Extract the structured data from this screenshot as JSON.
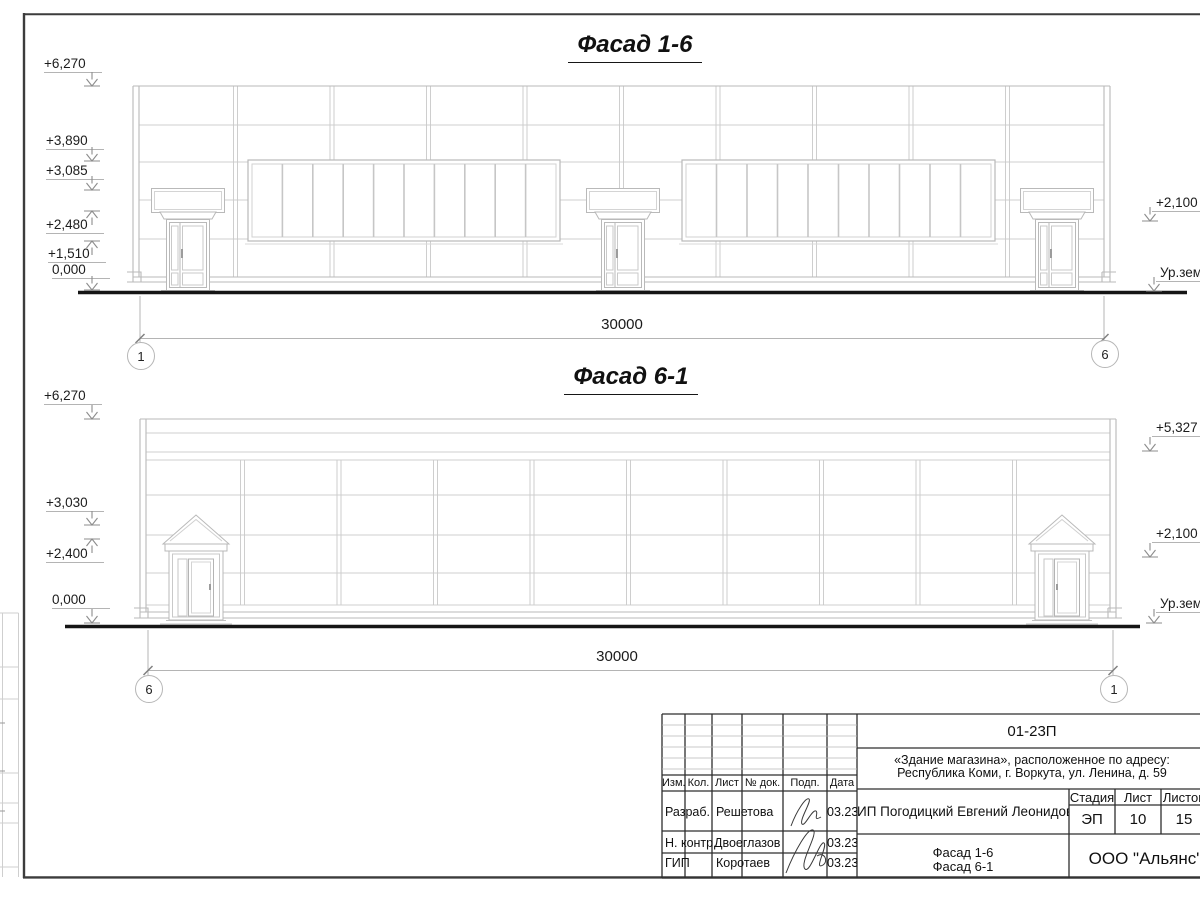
{
  "views": {
    "f16": {
      "title": "Фасад 1-6",
      "overall_dim": "30000",
      "axis_left": "1",
      "axis_right": "6",
      "levels_left": [
        "+6,270",
        "+3,890",
        "+3,085",
        "+2,480",
        "+1,510",
        "0,000"
      ],
      "levels_right": [
        "+2,100",
        "Ур.зем"
      ]
    },
    "f61": {
      "title": "Фасад 6-1",
      "overall_dim": "30000",
      "axis_left": "6",
      "axis_right": "1",
      "levels_left": [
        "+6,270",
        "+3,030",
        "+2,400",
        "0,000"
      ],
      "levels_right": [
        "+5,327",
        "+2,100",
        "Ур.зем"
      ]
    }
  },
  "titleblock": {
    "doc_number": "01-23П",
    "project_line1": "«Здание магазина», расположенное по адресу:",
    "project_line2": "Республика Коми, г. Воркута, ул. Ленина, д. 59",
    "client": "ИП Погодицкий Евгений Леонидович",
    "stage_label": "Стадия",
    "sheet_label": "Лист",
    "sheets_label": "Листов",
    "stage": "ЭП",
    "sheet": "10",
    "sheets": "15",
    "sheet_title_line1": "Фасад 1-6",
    "sheet_title_line2": "Фасад 6-1",
    "organization": "ООО \"Альянс\"",
    "columns": [
      "Изм.",
      "Кол.",
      "Лист",
      "№ док.",
      "Подп.",
      "Дата"
    ],
    "rows": [
      {
        "role": "Разраб.",
        "name": "Решетова",
        "date": "03.23"
      },
      {
        "role": "Н. контр.",
        "name": "Двоеглазов",
        "date": "03.23"
      },
      {
        "role": "ГИП",
        "name": "Коротаев",
        "date": "03.23"
      }
    ]
  },
  "colors": {
    "line_light": "#cfcfcf",
    "line_mid": "#b9b9b9",
    "ground": "#151515",
    "frame": "#3c3c3c",
    "tb_line": "#2e2e2e"
  }
}
